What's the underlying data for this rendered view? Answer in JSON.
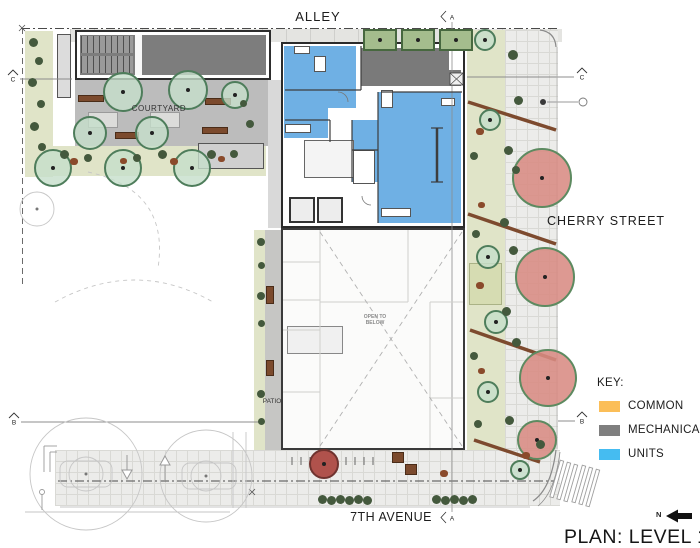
{
  "title": "PLAN: LEVEL 1",
  "north": {
    "label": "N"
  },
  "streets": {
    "alley": "ALLEY",
    "cherry_street": "CHERRY STREET",
    "seventh_avenue": "7TH AVENUE"
  },
  "site_labels": {
    "courtyard": "COURTYARD",
    "patio": "PATIO",
    "open_to_below_line1": "OPEN TO",
    "open_to_below_line2": "BELOW"
  },
  "key": {
    "heading": "KEY:",
    "items": [
      {
        "label": "COMMON",
        "color": "#FBBE58"
      },
      {
        "label": "MECHANICAL",
        "color": "#7F7F7F"
      },
      {
        "label": "UNITS",
        "color": "#45BCF1"
      }
    ]
  },
  "grid_markers": {
    "a": "A",
    "b": "B",
    "c": "C"
  },
  "plan_colors": {
    "units_fill": "#6FB0E4",
    "mechanical_fill": "#7A7A7A",
    "common_fill": "#FBBE58"
  }
}
